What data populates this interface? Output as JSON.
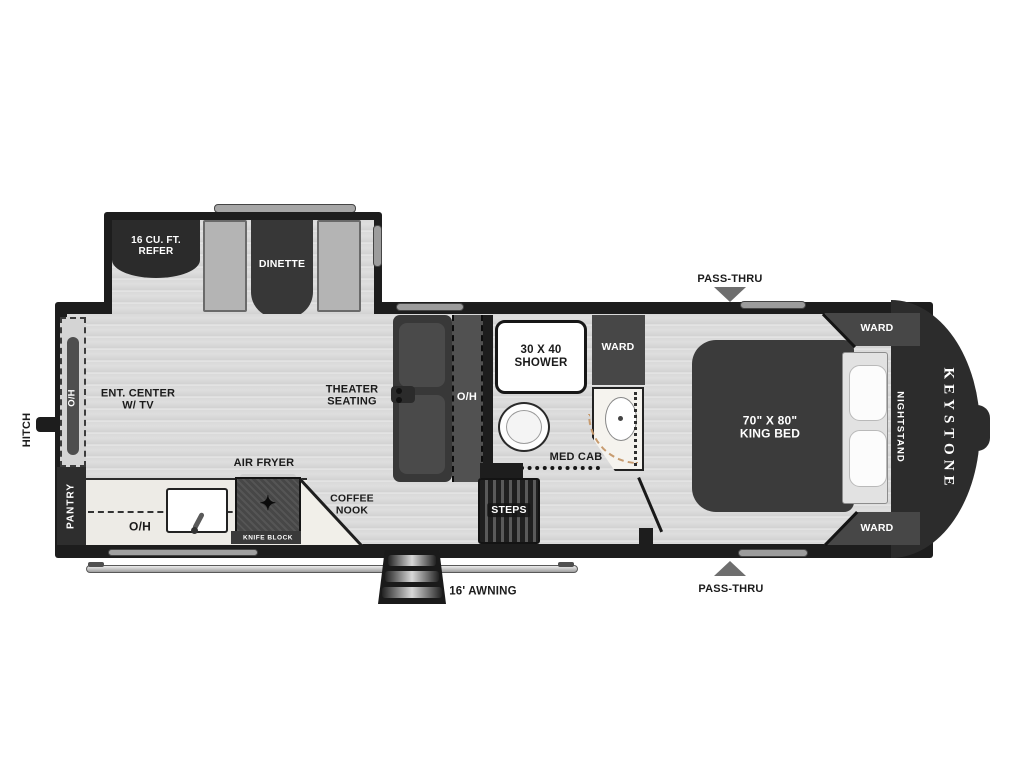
{
  "title": "Keystone fifth wheel RV floor plan",
  "colors": {
    "wall": "#1d1d1d",
    "furniture_dark": "#3a3a3a",
    "floor": "#d8d8d8",
    "counter": "#edebe6",
    "door_swing_arc": "#c79b6f",
    "pass_thru_arrow": "#6e6e6e"
  },
  "icons": {
    "burner": "✦"
  },
  "labels": {
    "refer": "16 CU. FT.\nREFER",
    "dinette": "DINETTE",
    "pass_thru_top": "PASS-THRU",
    "pass_thru_bottom": "PASS-THRU",
    "hitch": "HITCH",
    "oh_left": "O/H",
    "oh_mid": "O/H",
    "oh_kitchen": "O/H",
    "ent_center": "ENT. CENTER\nW/ TV",
    "theater": "THEATER\nSEATING",
    "pantry": "PANTRY",
    "air_fryer": "AIR FRYER",
    "knife_block": "KNIFE BLOCK",
    "coffee_nook": "COFFEE\nNOOK",
    "shower": "30 X 40\nSHOWER",
    "ward_bath": "WARD",
    "ward_bed_top": "WARD",
    "ward_bed_bottom": "WARD",
    "med_cab": "MED CAB",
    "steps": "STEPS",
    "awning": "16' AWNING",
    "king_bed": "70\" X 80\"\nKING BED",
    "nightstand": "NIGHTSTAND",
    "brand": "KEYSTONE"
  }
}
